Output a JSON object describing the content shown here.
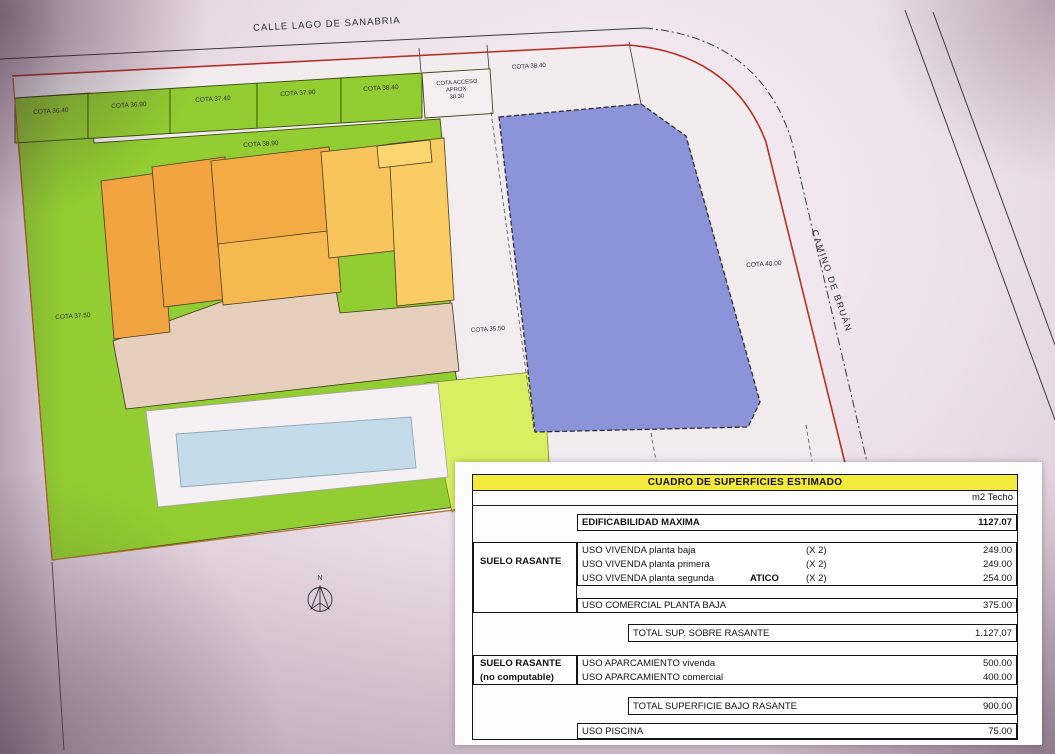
{
  "plan": {
    "street_top": "CALLE LAGO DE SANABRIA",
    "street_right": "CAMINO DE BRUÁN",
    "cota_cells": [
      "COTA 36.40",
      "COTA 36.90",
      "COTA 37.40",
      "COTA 37.90",
      "COTA 38.40"
    ],
    "cota_acceso_line1": "COTA ACCESO",
    "cota_acceso_line2": "APROX.",
    "cota_acceso_line3": "38.30",
    "cota_right": "COTA 38.40",
    "cota_mid": "COTA 38.90",
    "cota_left": "COTA 37.50",
    "cota_strip": "COTA 35.50",
    "cota_road": "COTA 40.00",
    "north_label": "N"
  },
  "table": {
    "title": "CUADRO DE SUPERFICIES ESTIMADO",
    "unit_header": "m2 Techo",
    "edificabilidad_label": "EDIFICABILIDAD MAXIMA",
    "edificabilidad_value": "1127.07",
    "suelo_rasante_label": "SUELO RASANTE",
    "vivienda_rows": [
      {
        "name": "USO VIVENDA planta baja",
        "mult": "(X 2)",
        "value": "249.00"
      },
      {
        "name": "USO VIVENDA planta primera",
        "mult": "(X 2)",
        "value": "249.00"
      },
      {
        "name": "USO VIVENDA planta segunda",
        "tag": "ATICO",
        "mult": "(X 2)",
        "value": "254.00"
      }
    ],
    "comercial_name": "USO COMERCIAL PLANTA BAJA",
    "comercial_value": "375.00",
    "total_sobre_label": "TOTAL  SUP. SOBRE RASANTE",
    "total_sobre_value": "1.127,07",
    "bajo_label1": "SUELO RASANTE",
    "bajo_label2": "(no computable)",
    "aparcamiento_rows": [
      {
        "name": "USO APARCAMIENTO vivenda",
        "value": "500.00"
      },
      {
        "name": "USO APARCAMIENTO comercial",
        "value": "400.00"
      }
    ],
    "total_bajo_label": "TOTAL SUPERFICIE  BAJO RASANTE",
    "total_bajo_value": "900.00",
    "piscina_name": "USO PISCINA",
    "piscina_value": "75.00"
  },
  "colors": {
    "parcel_green": "#92cd31",
    "light_green": "#d8ef62",
    "orange_dark": "#f2a440",
    "orange_mid1": "#f3ab45",
    "orange_mid2": "#f6b94f",
    "orange_light": "#f8c55c",
    "orange_lighter": "#f9cc64",
    "orange_lightest": "#fbd66e",
    "base_beige": "#e6cfbc",
    "building_blue": "#8b93d9",
    "pool_blue": "#c4dcea",
    "boundary_red": "#b43226",
    "table_yellow": "#f2e93a"
  }
}
